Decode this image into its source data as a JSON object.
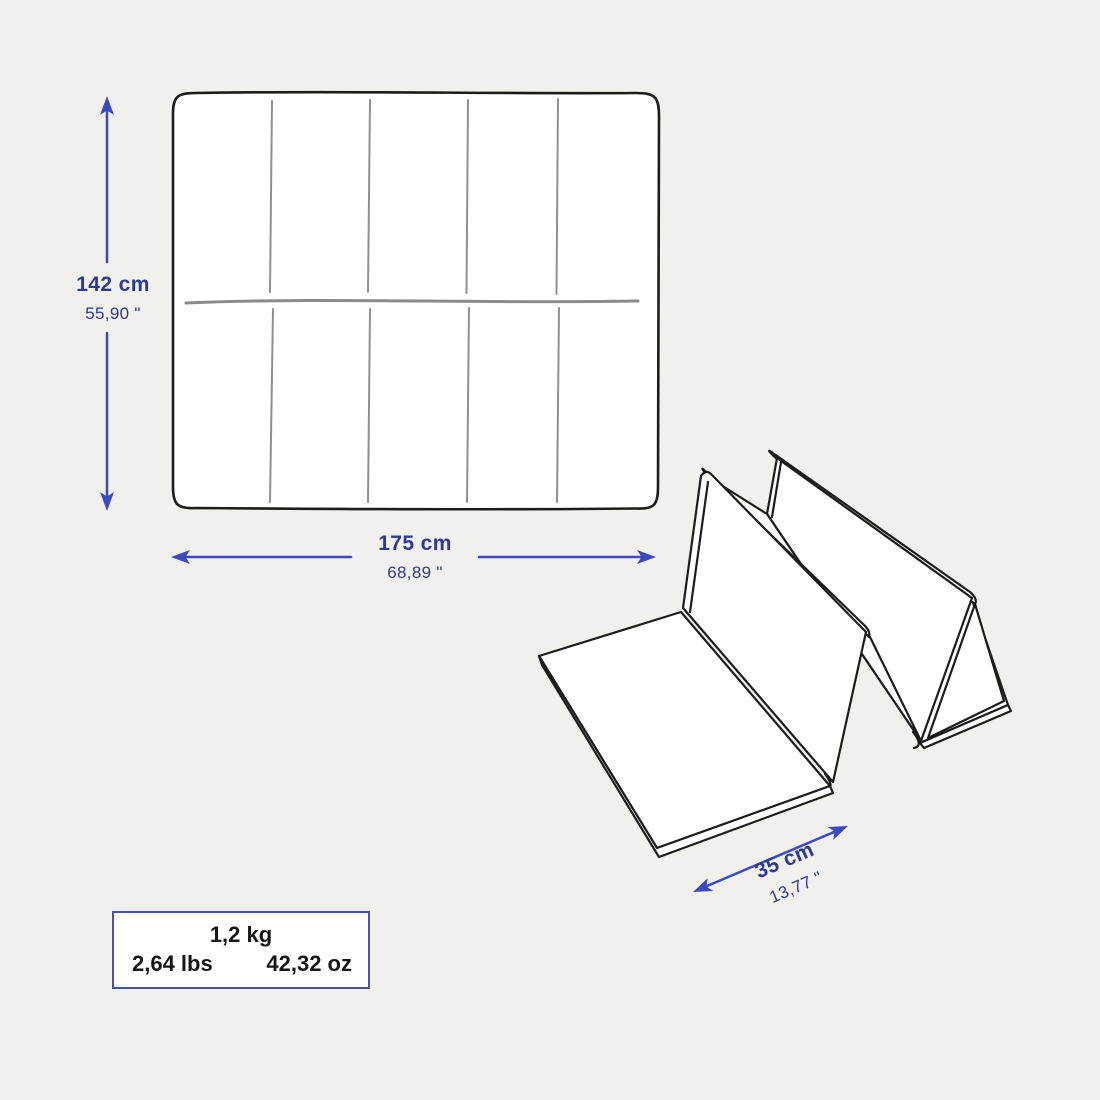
{
  "canvas": {
    "width_px": 1100,
    "height_px": 1100,
    "background_color": "#f1f0ed"
  },
  "colors": {
    "line_art_black": "#1c1c1c",
    "stitch_gray": "#8f8f8f",
    "dimension_text_blue": "#2c3996",
    "arrow_blue": "#3b49be",
    "weight_box_border_blue": "#4553ad",
    "weight_text": "#161616"
  },
  "icons": {
    "height_arrow": "double-headed-vertical-arrow",
    "width_arrow": "double-headed-horizontal-arrow",
    "depth_arrow": "double-headed-diagonal-arrow"
  },
  "dimensions": {
    "height": {
      "metric": "142 cm",
      "imperial": "55,90 \""
    },
    "width": {
      "metric": "175 cm",
      "imperial": "68,89 \""
    },
    "depth": {
      "metric": "35 cm",
      "imperial": "13,77 \""
    }
  },
  "weight": {
    "kg": "1,2 kg",
    "lbs": "2,64 lbs",
    "oz": "42,32 oz"
  }
}
